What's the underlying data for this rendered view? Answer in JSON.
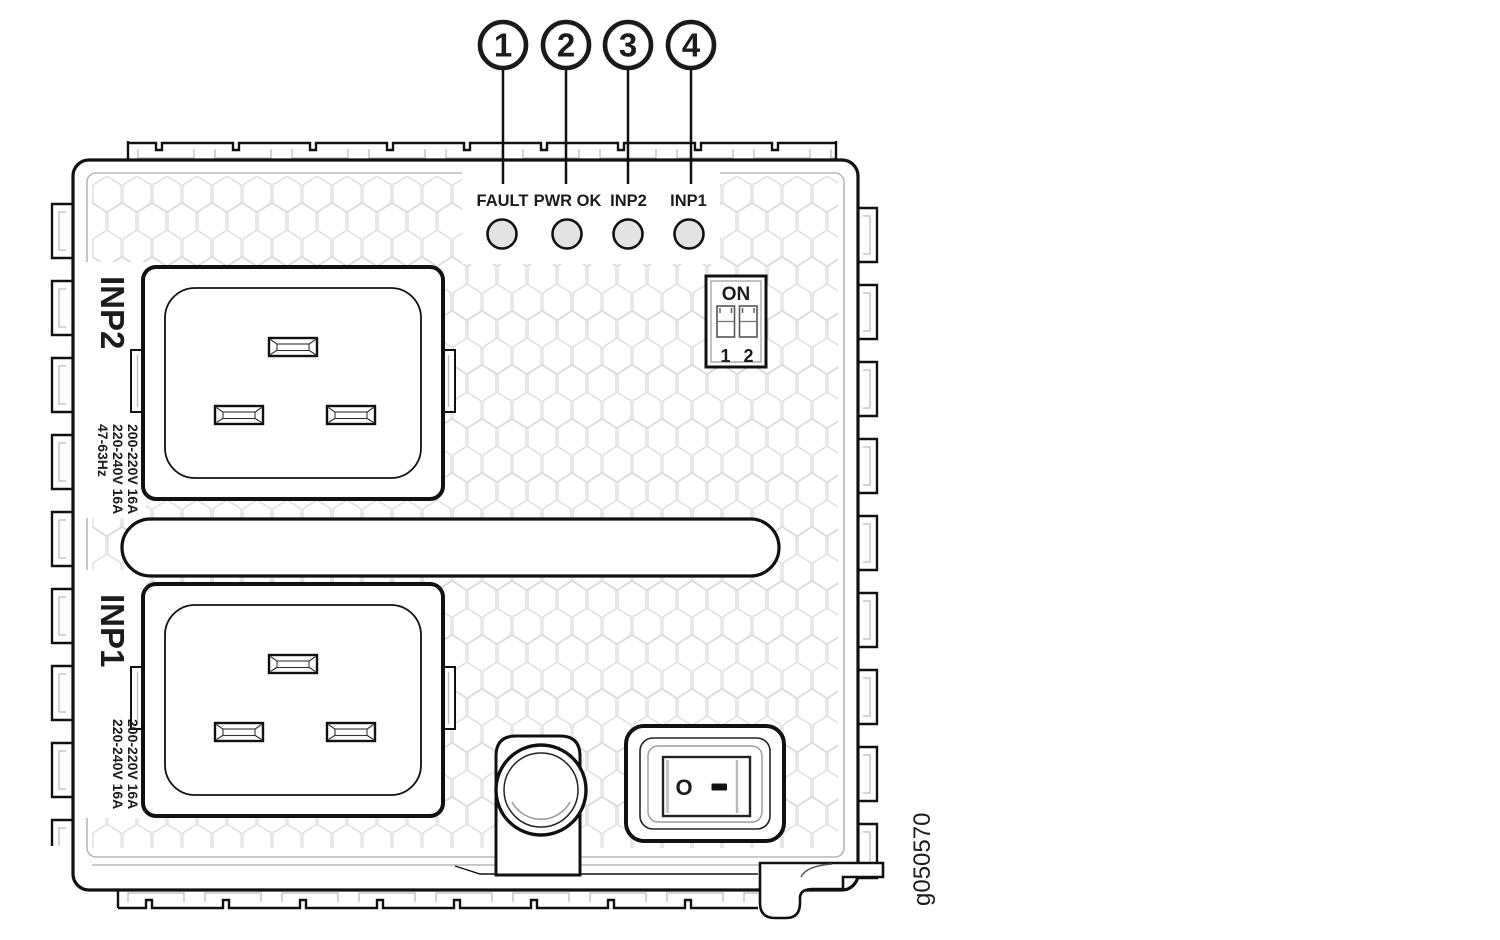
{
  "figure": {
    "callouts": [
      "1",
      "2",
      "3",
      "4"
    ],
    "led_labels": [
      "FAULT",
      "PWR OK",
      "INP2",
      "INP1"
    ],
    "dip_switch": {
      "label": "ON",
      "positions": [
        "1",
        "2"
      ]
    },
    "inlets": [
      {
        "label": "INP2",
        "ratings": [
          "200-220V 16A",
          "220-240V 16A",
          "47-63Hz"
        ]
      },
      {
        "label": "INP1",
        "ratings": [
          "200-220V 16A",
          "220-240V 16A"
        ]
      }
    ],
    "power_switch": {
      "off_symbol": "O",
      "on_symbol": "—"
    },
    "figure_id": "g050570",
    "colors": {
      "line": "#111111",
      "detail_gray": "#b7b7b7",
      "hex_gray": "#d8d8d8",
      "led_fill": "#e3e3e3",
      "text": "#1c1c1c"
    }
  }
}
